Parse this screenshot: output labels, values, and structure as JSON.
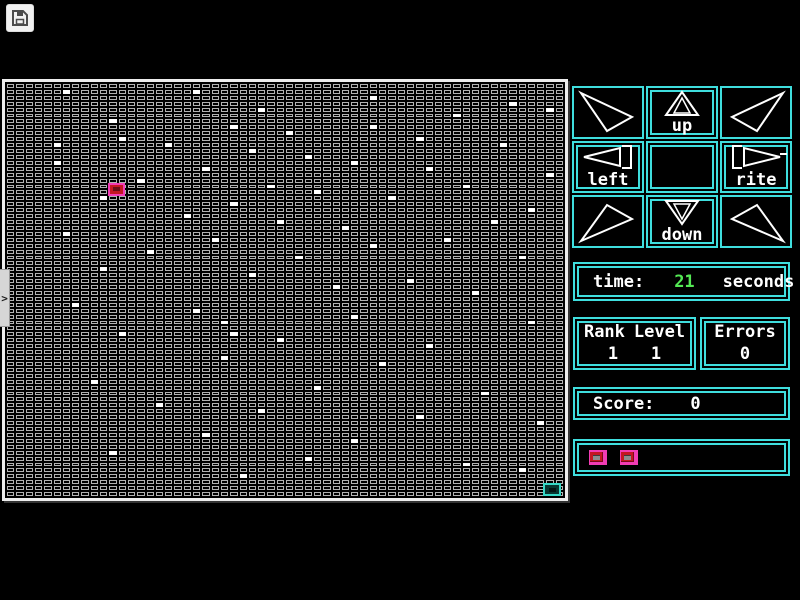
{
  "colors": {
    "cyan": "#3fdede",
    "green": "#54e854",
    "pink": "#f23cb4",
    "red": "#c41622",
    "teal": "#35d8c6",
    "cell_border": "#b2b2b2",
    "board_border": "#ededed"
  },
  "toolbar": {
    "save_icon": "floppy-disk"
  },
  "ui": {
    "side_tab_glyph": ">"
  },
  "maze": {
    "cols": 60,
    "rows": 70,
    "white_cells": [
      [
        6,
        1
      ],
      [
        20,
        1
      ],
      [
        39,
        2
      ],
      [
        54,
        3
      ],
      [
        27,
        4
      ],
      [
        58,
        4
      ],
      [
        48,
        5
      ],
      [
        11,
        6
      ],
      [
        24,
        7
      ],
      [
        39,
        7
      ],
      [
        30,
        8
      ],
      [
        12,
        9
      ],
      [
        44,
        9
      ],
      [
        5,
        10
      ],
      [
        17,
        10
      ],
      [
        53,
        10
      ],
      [
        26,
        11
      ],
      [
        32,
        12
      ],
      [
        5,
        13
      ],
      [
        37,
        13
      ],
      [
        21,
        14
      ],
      [
        45,
        14
      ],
      [
        58,
        15
      ],
      [
        14,
        16
      ],
      [
        28,
        17
      ],
      [
        49,
        17
      ],
      [
        33,
        18
      ],
      [
        10,
        19
      ],
      [
        41,
        19
      ],
      [
        24,
        20
      ],
      [
        56,
        21
      ],
      [
        19,
        22
      ],
      [
        29,
        23
      ],
      [
        52,
        23
      ],
      [
        36,
        24
      ],
      [
        6,
        25
      ],
      [
        22,
        26
      ],
      [
        47,
        26
      ],
      [
        39,
        27
      ],
      [
        15,
        28
      ],
      [
        31,
        29
      ],
      [
        55,
        29
      ],
      [
        10,
        31
      ],
      [
        26,
        32
      ],
      [
        43,
        33
      ],
      [
        35,
        34
      ],
      [
        50,
        35
      ],
      [
        7,
        37
      ],
      [
        20,
        38
      ],
      [
        37,
        39
      ],
      [
        23,
        40
      ],
      [
        56,
        40
      ],
      [
        12,
        42
      ],
      [
        24,
        42
      ],
      [
        29,
        43
      ],
      [
        45,
        44
      ],
      [
        23,
        46
      ],
      [
        40,
        47
      ],
      [
        9,
        50
      ],
      [
        33,
        51
      ],
      [
        51,
        52
      ],
      [
        16,
        54
      ],
      [
        27,
        55
      ],
      [
        44,
        56
      ],
      [
        57,
        57
      ],
      [
        21,
        59
      ],
      [
        37,
        60
      ],
      [
        11,
        62
      ],
      [
        32,
        63
      ],
      [
        49,
        64
      ],
      [
        55,
        65
      ],
      [
        25,
        66
      ]
    ],
    "player": {
      "col": 11,
      "row": 17
    },
    "goal": {
      "col": 58,
      "row": 68
    }
  },
  "dpad": {
    "labels": {
      "up": "up",
      "down": "down",
      "left": "left",
      "rite": "rite"
    }
  },
  "stats": {
    "time": {
      "label": "time:",
      "value": "21",
      "unit": "seconds"
    },
    "rank": {
      "label": "Rank",
      "value": "1"
    },
    "level": {
      "label": "Level",
      "value": "1"
    },
    "errors": {
      "label": "Errors",
      "value": "0"
    },
    "score": {
      "label": "Score:",
      "value": "0"
    },
    "lives": {
      "count": 2
    }
  }
}
